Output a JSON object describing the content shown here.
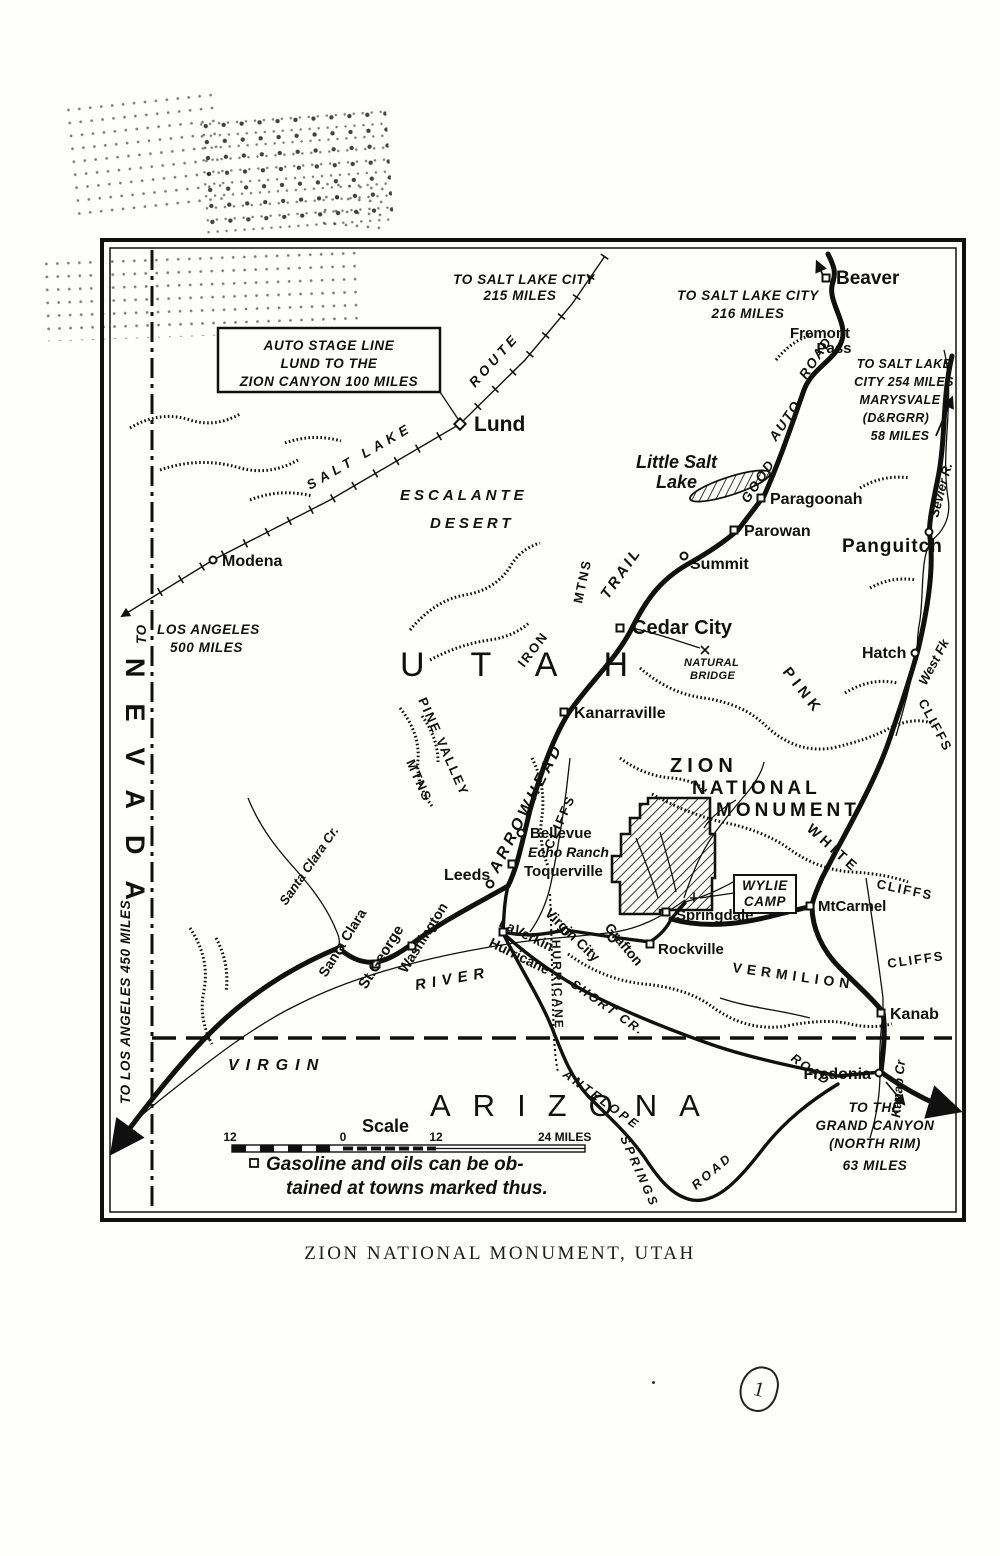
{
  "page": {
    "caption": "ZION NATIONAL MONUMENT, UTAH",
    "page_number": "1"
  },
  "map": {
    "states": {
      "utah": "UTAH",
      "arizona": "ARIZONA",
      "nevada": "NEVADA"
    },
    "monument": {
      "l1": "ZION",
      "l2": "NATIONAL",
      "l3": "MONUMENT"
    },
    "boxes": {
      "auto_stage_1": "AUTO STAGE LINE",
      "auto_stage_2": "LUND TO THE",
      "auto_stage_3": "ZION CANYON 100 MILES",
      "wylie_1": "WYLIE",
      "wylie_2": "CAMP"
    },
    "routes": {
      "slc215_1": "TO SALT LAKE CITY",
      "slc215_2": "215 MILES",
      "slc216_1": "TO SALT LAKE CITY",
      "slc216_2": "216 MILES",
      "slc254_1": "TO SALT LAKE",
      "slc254_2": "CITY 254 MILES",
      "slc254_3": "MARYSVALE",
      "slc254_4": "(D&RGRR)",
      "slc254_5": "58 MILES",
      "la500_to": "TO",
      "la500_1": "LOS ANGELES",
      "la500_2": "500 MILES",
      "la450": "TO LOS ANGELES 450 MILES",
      "gc_1": "TO THE",
      "gc_2": "GRAND CANYON",
      "gc_3": "(NORTH RIM)",
      "gc_4": "63 MILES"
    },
    "legend": {
      "scale_label": "Scale",
      "s12a": "12",
      "s0": "0",
      "s12b": "12",
      "s24": "24 MILES",
      "gas_1": "Gasoline and oils can be ob-",
      "gas_2": "tained at towns marked thus."
    },
    "towns": {
      "beaver": "Beaver",
      "fremont_1": "Fremont",
      "fremont_2": "Pass",
      "lund": "Lund",
      "modena": "Modena",
      "paragoonah": "Paragoonah",
      "parowan": "Parowan",
      "summit": "Summit",
      "panguitch": "Panguitch",
      "hatch": "Hatch",
      "cedar_city": "Cedar City",
      "kanarraville": "Kanarraville",
      "bellevue": "Bellevue",
      "echo_ranch": "Echo Ranch",
      "toquerville": "Toquerville",
      "leeds": "Leeds",
      "santa_clara": "Santa Clara",
      "st_george": "St.George",
      "washington": "Washington",
      "laverkin": "LaVerkin",
      "hurricane": "Hurricane",
      "virgin_city": "Virgin City",
      "grafton": "Grafton",
      "rockville": "Rockville",
      "springdale": "Springdale",
      "mt_carmel": "MtCarmel",
      "kanab": "Kanab",
      "fredonia": "Fredonia"
    },
    "features": {
      "salt_lake": "SALT LAKE",
      "route": "ROUTE",
      "good": "GOOD",
      "auto": "AUTO",
      "road": "ROAD",
      "trail": "TRAIL",
      "arrowhead": "ARROWHEAD",
      "iron": "IRON",
      "iron_mtns": "MTNS",
      "pine_valley": "PINE VALLEY",
      "pv_mtns": "MTNS",
      "escalante": "ESCALANTE",
      "desert": "DESERT",
      "little_salt_1": "Little Salt",
      "little_salt_2": "Lake",
      "natural_1": "NATURAL",
      "natural_2": "BRIDGE",
      "pink": "PINK",
      "pink_cliffs": "CLIFFS",
      "white": "WHITE",
      "white_cliffs": "CLIFFS",
      "vermilion": "VERMILION",
      "vermilion_cliffs": "CLIFFS",
      "gray_cliffs": "CLIFFS",
      "sevier": "Sevier R.",
      "west_fk": "West Fk",
      "kanab_cr": "Kanab Cr",
      "santa_clara_cr": "Santa Clara Cr.",
      "virgin": "VIRGIN",
      "river": "RIVER",
      "hurricane_fault": "HURRICANE",
      "short_cr": "SHORT CR.",
      "short_cr_road": "ROAD",
      "antelope": "ANTELOPE",
      "springs": "SPRINGS",
      "springs_road": "ROAD"
    }
  }
}
